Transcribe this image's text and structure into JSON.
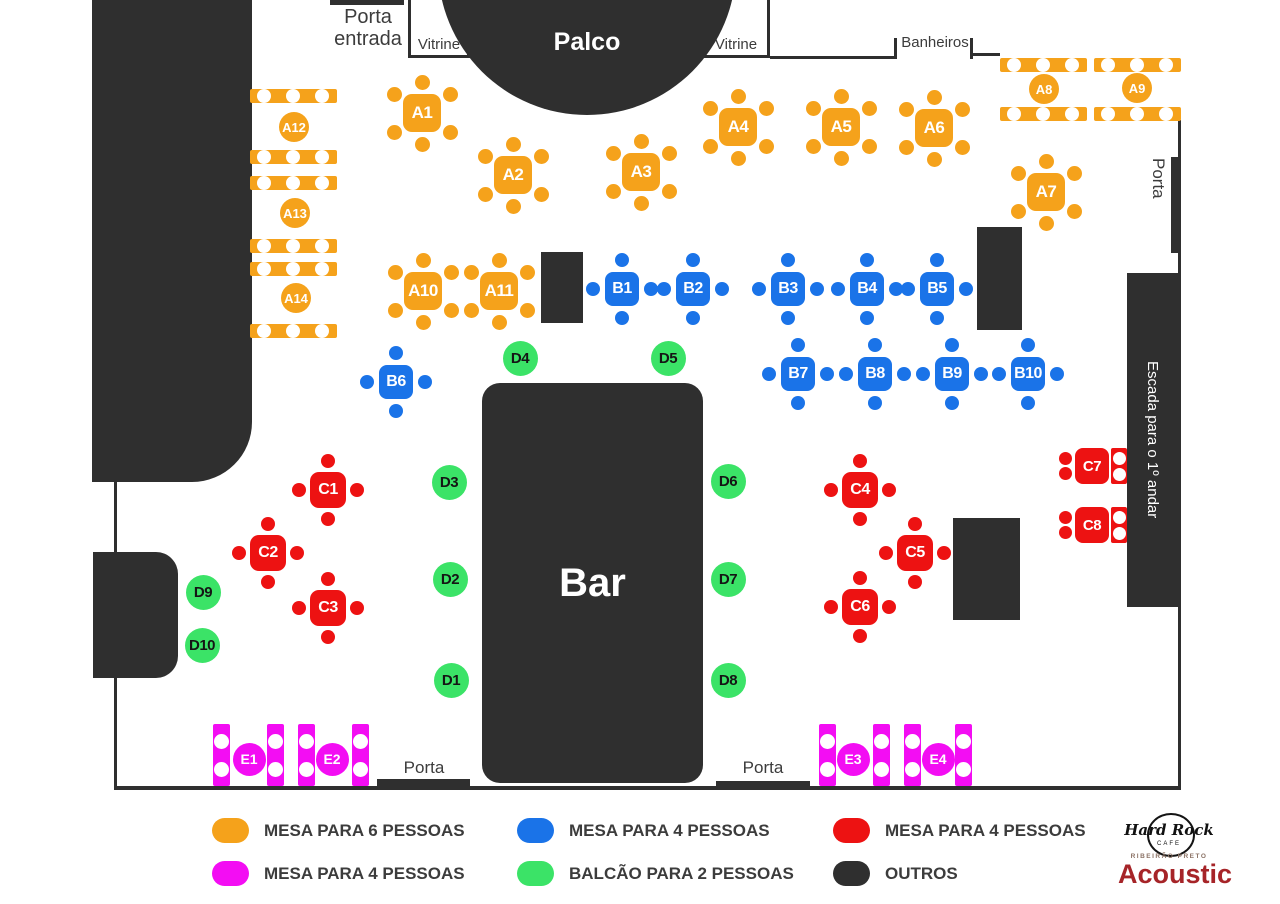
{
  "colors": {
    "orange": "#F5A21B",
    "blue": "#1A73E8",
    "red": "#ED1212",
    "green": "#3BE367",
    "magenta": "#F30DF3",
    "black": "#2F2F2F",
    "label_text": "#3C3C3C",
    "acoustic_red": "#A62428",
    "location_text": "#8B7265"
  },
  "labels": {
    "porta_entrada": [
      "Porta",
      "entrada"
    ],
    "vitrine_left": "Vitrine",
    "vitrine_right": "Vitrine",
    "palco": "Palco",
    "banheiros": "Banheiros",
    "porta_right": "Porta",
    "escada": "Escada para o 1º andar",
    "bar": "Bar",
    "porta_bottom_left": "Porta",
    "porta_bottom_right": "Porta"
  },
  "tables": {
    "mesa6_square": [
      [
        "A1",
        422,
        113
      ],
      [
        "A2",
        513,
        175
      ],
      [
        "A3",
        641,
        172
      ],
      [
        "A4",
        738,
        127
      ],
      [
        "A5",
        841,
        127
      ],
      [
        "A6",
        934,
        128
      ],
      [
        "A7",
        1046,
        192
      ],
      [
        "A10",
        423,
        291
      ],
      [
        "A11",
        499,
        291
      ]
    ],
    "mesa6_double_bar": [
      {
        "id": "A8",
        "bar_x": 1000,
        "bar_ys": [
          58,
          107
        ],
        "label": [
          1044,
          89
        ]
      },
      {
        "id": "A9",
        "bar_x": 1094,
        "bar_ys": [
          58,
          107
        ],
        "label": [
          1137,
          88
        ]
      },
      {
        "id": "A12",
        "bar_x": 250,
        "bar_ys": [
          89,
          150
        ],
        "label": [
          294,
          127
        ]
      },
      {
        "id": "A13",
        "bar_x": 250,
        "bar_ys": [
          176,
          239
        ],
        "label": [
          295,
          213
        ]
      },
      {
        "id": "A14",
        "bar_x": 250,
        "bar_ys": [
          262,
          324
        ],
        "label": [
          296,
          298
        ]
      }
    ],
    "mesa4_blue": [
      [
        "B1",
        622,
        289
      ],
      [
        "B2",
        693,
        289
      ],
      [
        "B3",
        788,
        289
      ],
      [
        "B4",
        867,
        289
      ],
      [
        "B5",
        937,
        289
      ],
      [
        "B6",
        396,
        382
      ],
      [
        "B7",
        798,
        374
      ],
      [
        "B8",
        875,
        374
      ],
      [
        "B9",
        952,
        374
      ],
      [
        "B10",
        1028,
        374
      ]
    ],
    "mesa4_red": [
      [
        "C1",
        328,
        490
      ],
      [
        "C2",
        268,
        553
      ],
      [
        "C3",
        328,
        608
      ],
      [
        "C4",
        860,
        490
      ],
      [
        "C5",
        915,
        553
      ],
      [
        "C6",
        860,
        607
      ]
    ],
    "mesa4_red_wall": [
      [
        "C7",
        1092,
        466
      ],
      [
        "C8",
        1092,
        525
      ]
    ],
    "balcao2_green": [
      [
        "D1",
        451,
        680
      ],
      [
        "D2",
        450,
        579
      ],
      [
        "D3",
        449,
        482
      ],
      [
        "D4",
        520,
        358
      ],
      [
        "D5",
        668,
        358
      ],
      [
        "D6",
        728,
        481
      ],
      [
        "D7",
        728,
        579
      ],
      [
        "D8",
        728,
        680
      ],
      [
        "D9",
        203,
        592
      ],
      [
        "D10",
        202,
        645
      ]
    ],
    "mesa4_magenta": [
      {
        "id": "E1",
        "bar_xs": [
          213,
          267
        ],
        "label": [
          249,
          759
        ]
      },
      {
        "id": "E2",
        "bar_xs": [
          298,
          352
        ],
        "label": [
          332,
          759
        ]
      },
      {
        "id": "E3",
        "bar_xs": [
          819,
          873
        ],
        "label": [
          853,
          759
        ]
      },
      {
        "id": "E4",
        "bar_xs": [
          904,
          955
        ],
        "label": [
          938,
          759
        ]
      }
    ]
  },
  "legend": {
    "items": [
      {
        "color_key": "orange",
        "label": "MESA PARA 6 PESSOAS"
      },
      {
        "color_key": "blue",
        "label": "MESA PARA 4 PESSOAS"
      },
      {
        "color_key": "red",
        "label": "MESA PARA 4 PESSOAS"
      },
      {
        "color_key": "magenta",
        "label": "MESA PARA 4 PESSOAS"
      },
      {
        "color_key": "green",
        "label": "BALCÃO PARA 2 PESSOAS"
      },
      {
        "color_key": "black",
        "label": "OUTROS"
      }
    ]
  },
  "logo": {
    "name": "Hard Rock",
    "cafe": "CAFE",
    "location": "RIBEIRÃO PRETO",
    "event": "Acoustic"
  }
}
